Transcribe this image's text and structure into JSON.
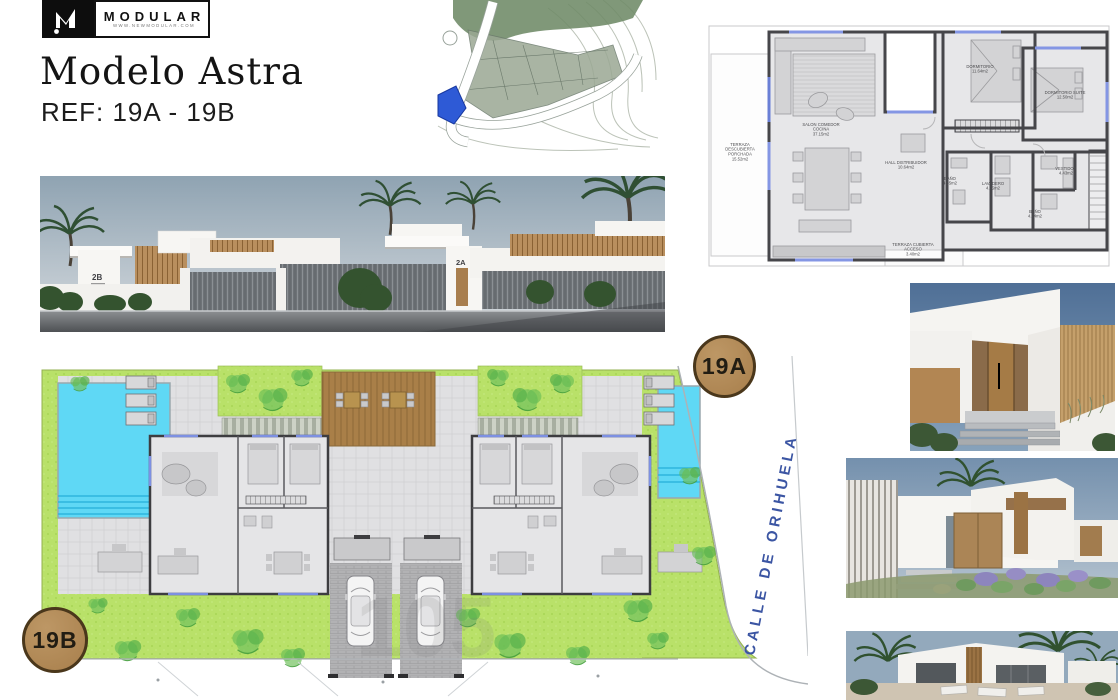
{
  "brand": {
    "logo_text": "MODULAR",
    "website": "WWW.NEWMODULAR.COM"
  },
  "header": {
    "title": "Modelo Astra",
    "reference": "REF: 19A - 19B"
  },
  "badges": {
    "unit_top": "19A",
    "unit_bottom": "19B"
  },
  "street_render": {
    "house_left_number": "2B",
    "house_right_number": "2A"
  },
  "site_plan": {
    "street_name": "CALLE DE ORIHUELA",
    "watermark": "105"
  },
  "floor_plan": {
    "rooms": [
      {
        "name": "TERRAZA DESCUBIERTA PORCHADA",
        "area": "15.52m2"
      },
      {
        "name": "SALON COMEDOR COCINA",
        "area": "37.15m2"
      },
      {
        "name": "HALL DISTRIBUIDOR",
        "area": "10.64m2"
      },
      {
        "name": "DORMITORIO",
        "area": "11.64m2"
      },
      {
        "name": "DORMITORIO SUITE",
        "area": "12.50m2"
      },
      {
        "name": "BAÑO",
        "area": "4.35m2"
      },
      {
        "name": "LAVADERO",
        "area": "4.25m2"
      },
      {
        "name": "VESTIDOR",
        "area": "4.43m2"
      },
      {
        "name": "BAÑO",
        "area": "4.74m2"
      },
      {
        "name": "TERRAZA CUBIERTA ACCESO",
        "area": "3.40m2"
      }
    ]
  },
  "colors": {
    "badge_fill": "#b28a58",
    "badge_border": "#4a371b",
    "pool": "#5fd8f5",
    "lawn": "#b9e169",
    "street_text": "#3b55a3",
    "deck": "#a97f48",
    "plan_wall": "#46464a",
    "logo_bg": "#0d0d0d"
  }
}
